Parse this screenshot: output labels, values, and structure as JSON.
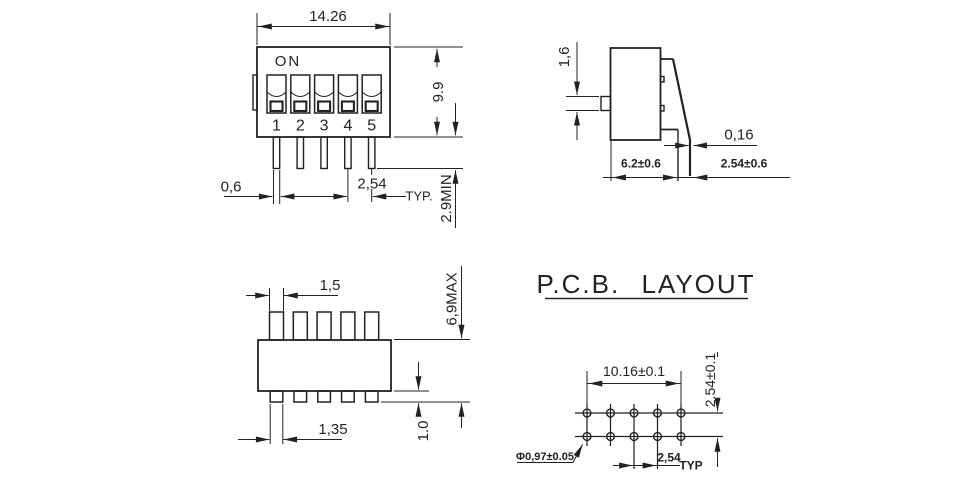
{
  "drawing_title": "DIP switch dimensional drawing",
  "front_view": {
    "on_label": "ON",
    "position_labels": [
      "1",
      "2",
      "3",
      "4",
      "5"
    ],
    "dim_body_width": "14.26",
    "dim_body_height": "9.9",
    "dim_pin_width": "0,6",
    "dim_pin_pitch": "2,54",
    "dim_pin_pitch_qualifier": "TYP.",
    "dim_pin_length": "2.9MIN"
  },
  "side_view": {
    "dim_actuator_height": "1,6",
    "dim_terminal_thickness": "0,16",
    "dim_body_depth": "6.2±0.6",
    "dim_terminal_offset": "2.54±0.6"
  },
  "top_view": {
    "dim_actuator_width": "1,5",
    "dim_overall_height": "6,9MAX",
    "dim_terminal_tab_width": "1,35",
    "dim_terminal_tab_height": "1.0"
  },
  "pcb_layout": {
    "heading": "P.C.B. LAYOUT",
    "dim_hole_row_span": "10.16±0.1",
    "dim_row_pitch": "2.54±0.1",
    "dim_hole_diameter": "Φ0,97±0.05",
    "dim_hole_pitch": "2,54",
    "dim_hole_pitch_qualifier": "TYP"
  },
  "colors": {
    "line": "#222222",
    "background": "#ffffff"
  }
}
